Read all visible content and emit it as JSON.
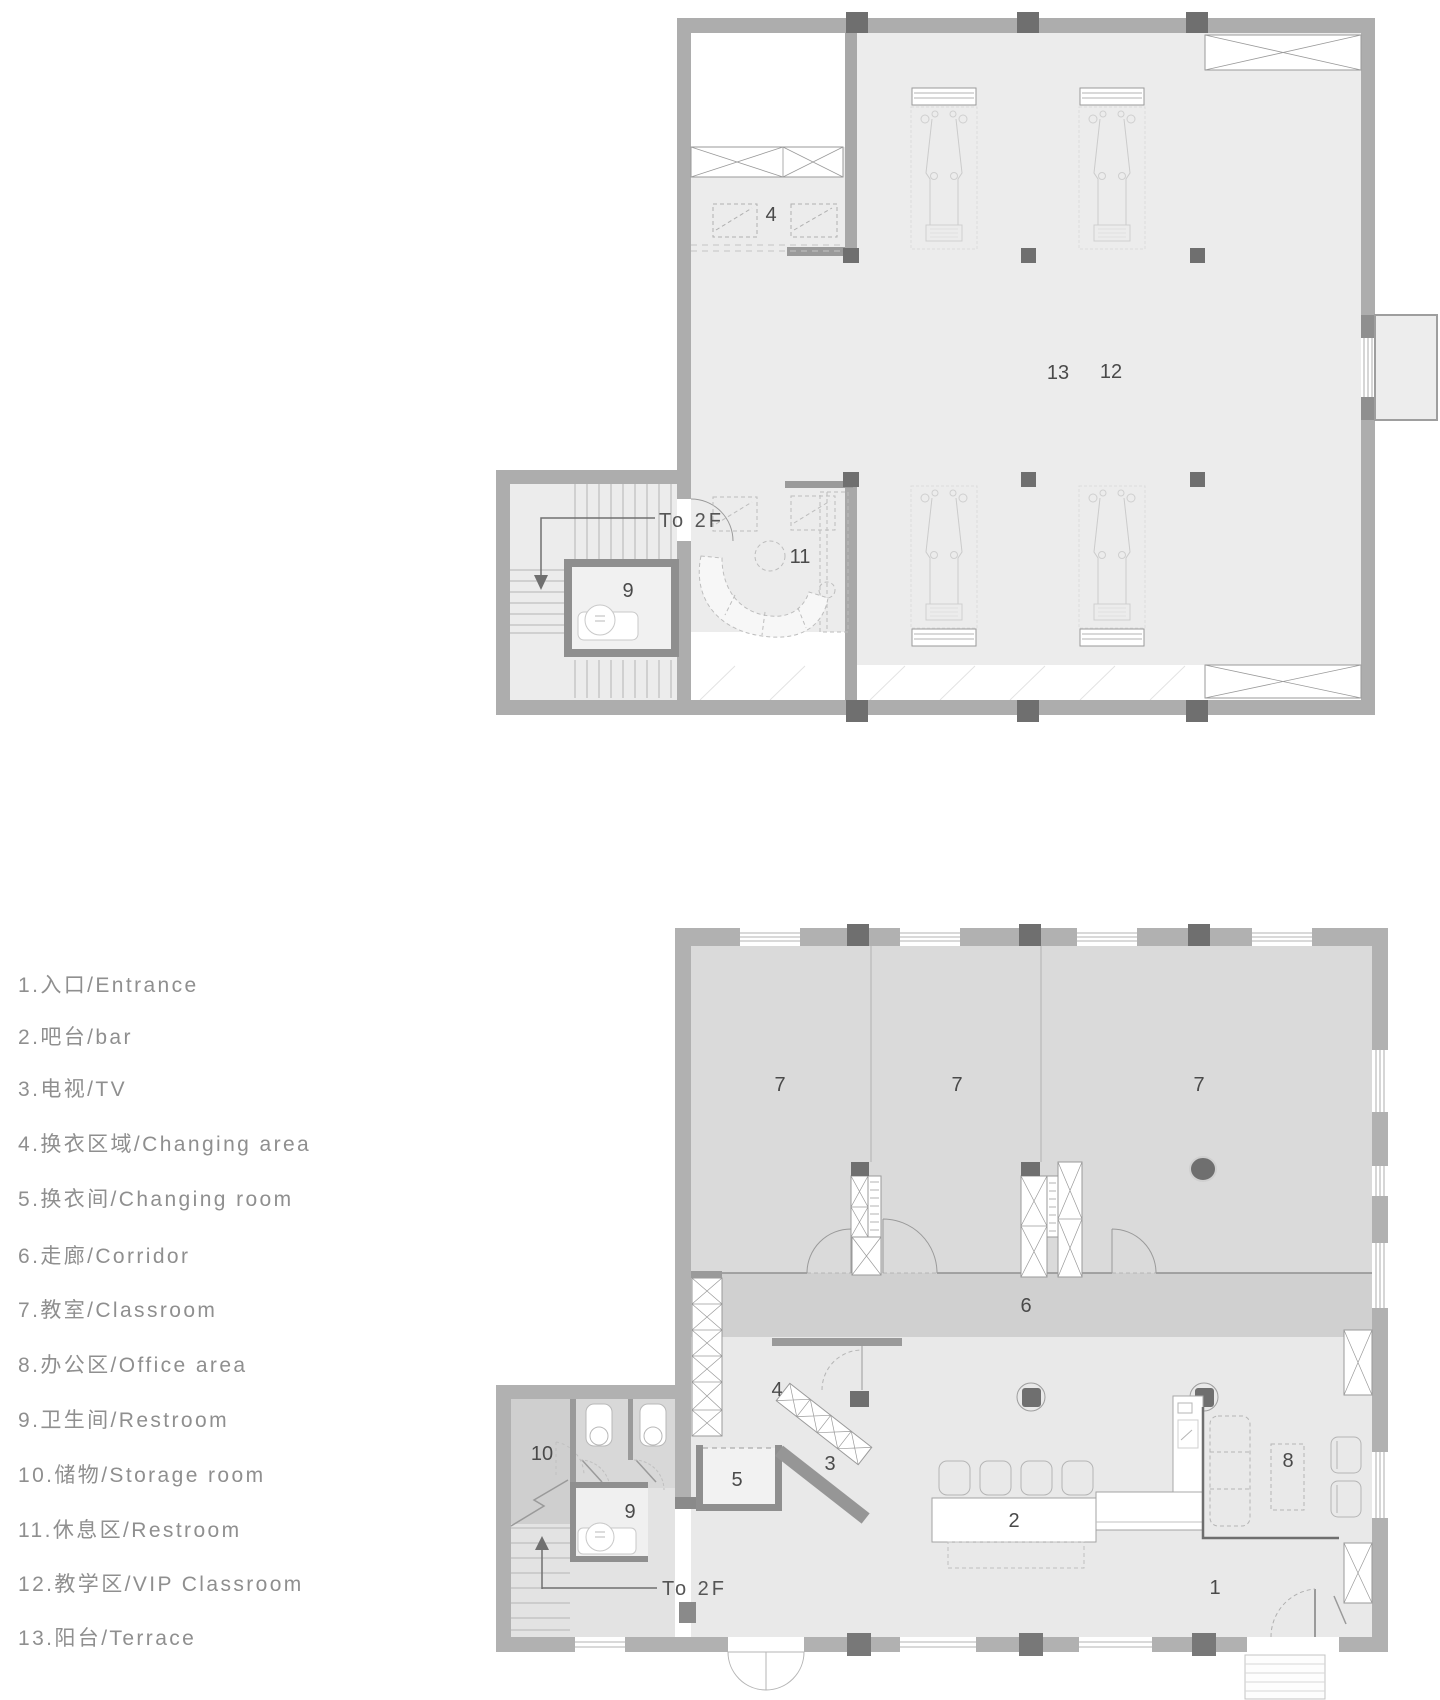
{
  "legend": {
    "items": [
      "1.入口/Entrance",
      "2.吧台/bar",
      "3.电视/TV",
      "4.换衣区域/Changing area",
      "5.换衣间/Changing room",
      "6.走廊/Corridor",
      "7.教室/Classroom",
      "8.办公区/Office area",
      "9.卫生间/Restroom",
      "10.储物/Storage room",
      "11.休息区/Restroom",
      "12.教学区/VIP Classroom",
      "13.阳台/Terrace"
    ]
  },
  "floor2": {
    "to_2f": "To 2F",
    "labels": {
      "changing_area": "4",
      "restroom": "9",
      "lounge": "11",
      "terrace": "13",
      "vip_classroom": "12"
    }
  },
  "floor1": {
    "to_2f": "To 2F",
    "labels": {
      "classroom_1": "7",
      "classroom_2": "7",
      "classroom_3": "7",
      "corridor": "6",
      "changing_area": "4",
      "changing_room": "5",
      "tv": "3",
      "bar": "2",
      "office": "8",
      "entrance": "1",
      "restroom": "9",
      "storage": "10"
    }
  },
  "colors": {
    "wall": "#b1b1b1",
    "wall_dark": "#8f8f8f",
    "column": "#6f6f6f",
    "room_fill_light": "#ececec",
    "room_fill_mid": "#dadada",
    "corridor_fill": "#d0d0d0",
    "storage_fill": "#cfcfcf",
    "label_text": "#4a4a4a",
    "legend_text": "#8f8f8f"
  }
}
